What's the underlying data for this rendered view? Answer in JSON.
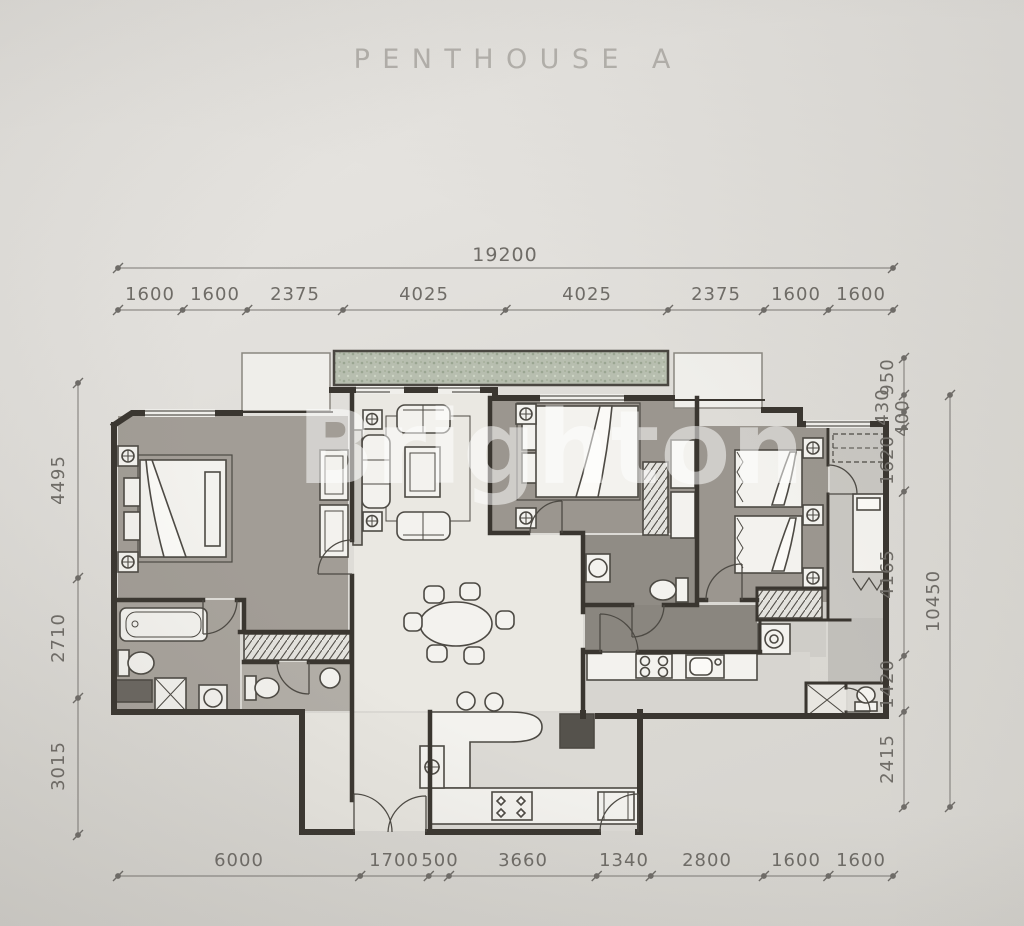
{
  "title": "PENTHOUSE A",
  "watermark": "Brighton",
  "dimensions": {
    "top_overall": "19200",
    "top_segments": [
      "1600",
      "1600",
      "2375",
      "4025",
      "4025",
      "2375",
      "1600",
      "1600"
    ],
    "bottom_segments": [
      "6000",
      "1700",
      "500",
      "3660",
      "1340",
      "2800",
      "1600",
      "1600"
    ],
    "left_segments": [
      "4495",
      "2710",
      "3015"
    ],
    "right_overall": "10450",
    "right_segments": [
      "950",
      "430",
      "400",
      "1620",
      "4165",
      "1420",
      "2415"
    ]
  }
}
